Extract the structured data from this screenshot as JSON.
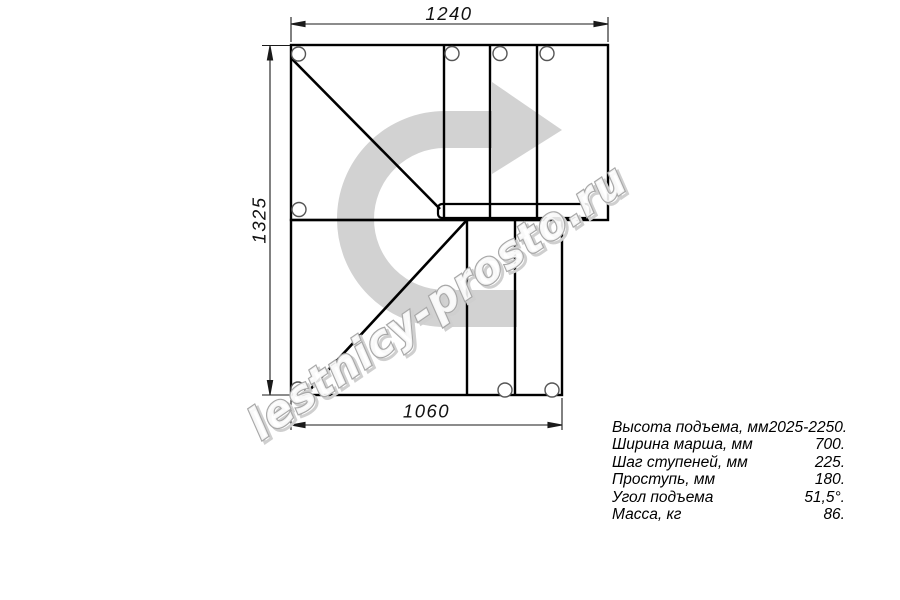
{
  "drawing": {
    "type": "staircase plan, top view, U-turn to the right",
    "dimensions": {
      "top_width_mm": "1240",
      "left_height_mm": "1325",
      "bottom_width_mm": "1060"
    },
    "line_color": "#000000",
    "dim_color": "#1a1a1a"
  },
  "watermark": {
    "text": "lestnicy-prosto.ru",
    "arrow_color": "#d2d2d2",
    "outline_color": "#a8a8a8",
    "shadow_color": "#cfcfcf"
  },
  "specs": {
    "rows": [
      {
        "label": "Высота подъема, мм",
        "value": "2025-2250."
      },
      {
        "label": "Ширина марша, мм",
        "value": "700."
      },
      {
        "label": "Шаг ступеней, мм",
        "value": "225."
      },
      {
        "label": "Проступь, мм",
        "value": "180."
      },
      {
        "label": "Угол подъема",
        "value": "51,5°."
      },
      {
        "label": "Масса, кг",
        "value": "86."
      }
    ]
  }
}
